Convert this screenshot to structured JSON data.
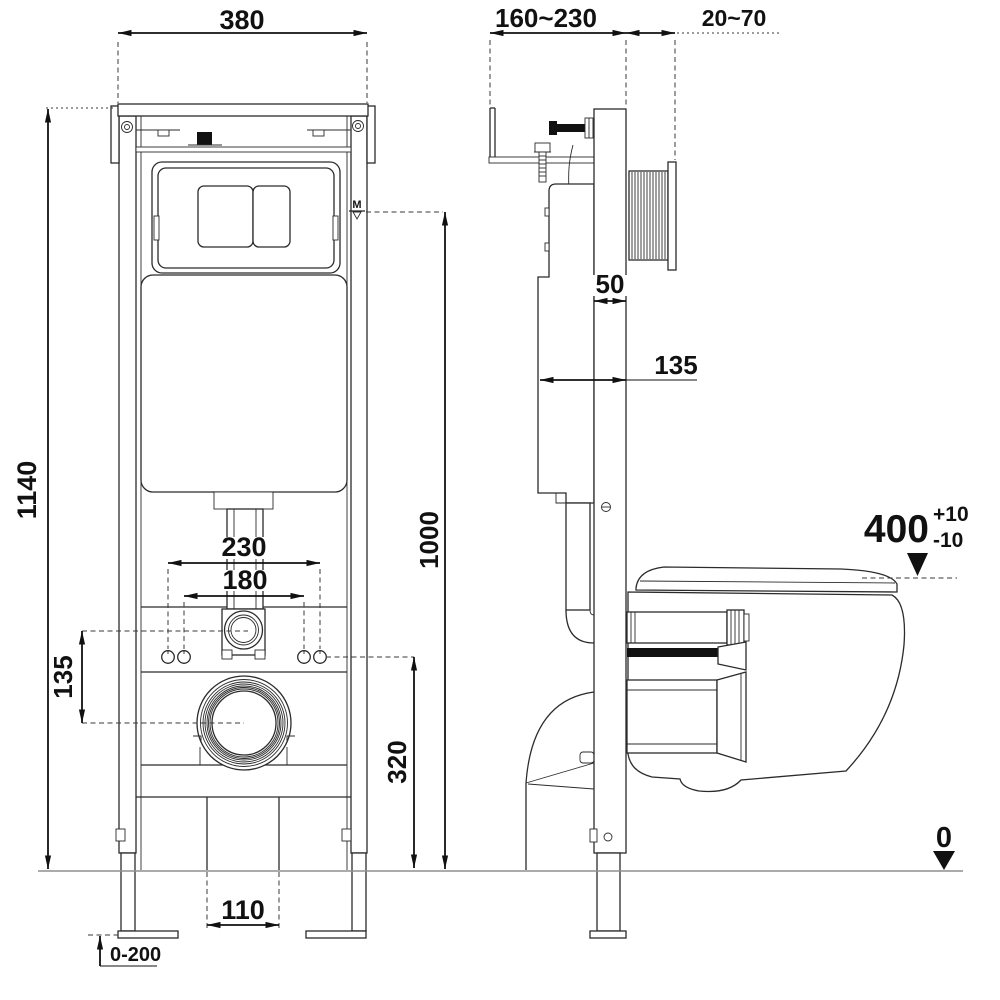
{
  "front_view": {
    "frame_width": "380",
    "total_height": "1140",
    "flush_level_height": "1000",
    "level_mark": "M",
    "hole_spacing_outer": "230",
    "hole_spacing_inner": "180",
    "inlet_drain_offset": "135",
    "drain_center_height": "320",
    "drain_opening_width": "110",
    "foot_adjustment_range": "0-200"
  },
  "side_view": {
    "frame_depth_range": "160~230",
    "wall_finish_range": "20~70",
    "profile_depth": "50",
    "cistern_depth": "135",
    "bowl_height": "400",
    "bowl_height_tol_plus": "+10",
    "bowl_height_tol_minus": "-10",
    "floor_level": "0"
  },
  "colors": {
    "line": "#2b2b2b",
    "dimension": "#111111",
    "floor_line": "#8f8f8f",
    "background": "#ffffff",
    "solid_black": "#111111"
  }
}
